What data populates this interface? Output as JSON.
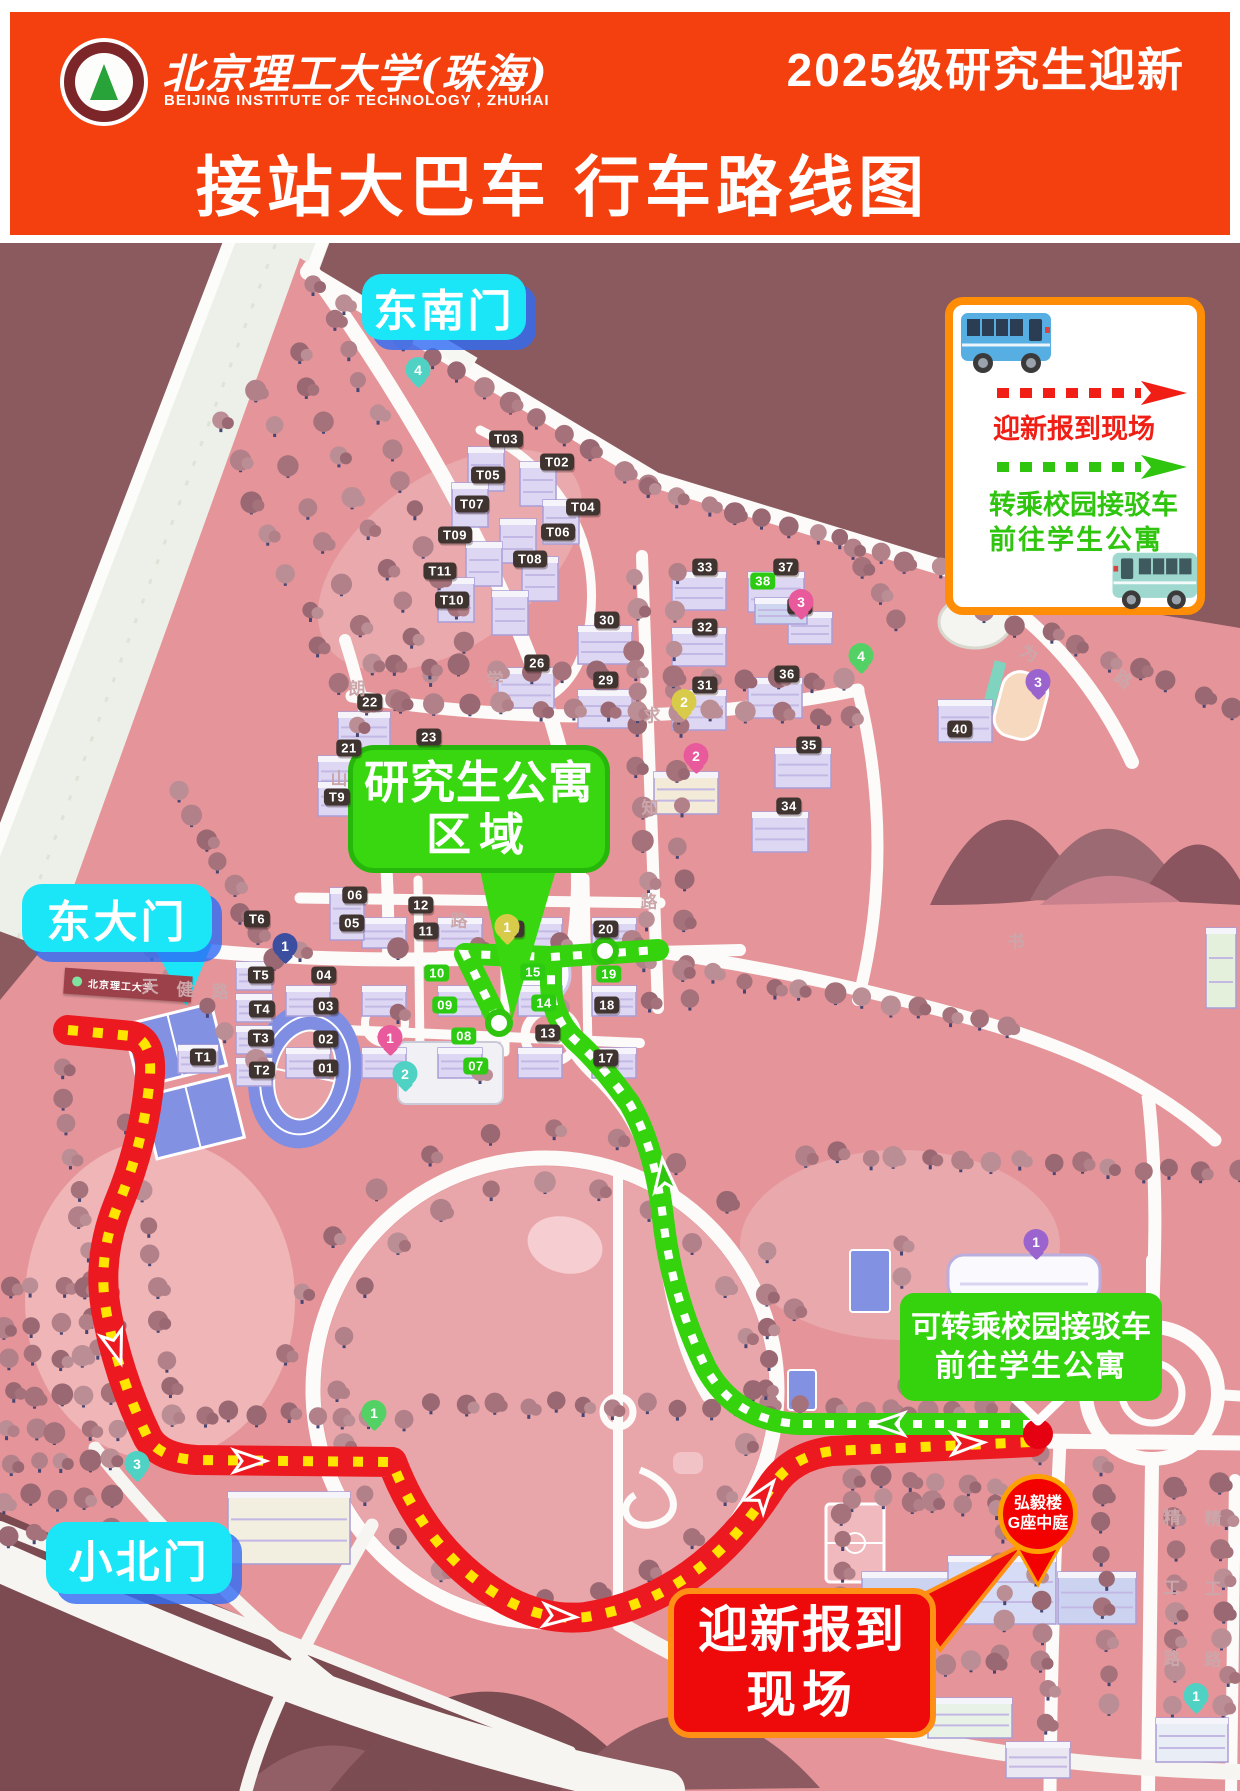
{
  "header": {
    "university_zh": "北京理工大学(珠海)",
    "university_en": "BEIJING INSTITUTE OF TECHNOLOGY , ZHUHAI",
    "event": "2025级研究生迎新",
    "title": "接站大巴车 行车路线图"
  },
  "legend": {
    "red_route_label": "迎新报到现场",
    "green_route_label_line1": "转乘校园接驳车",
    "green_route_label_line2": "前往学生公寓",
    "bus_icon_1": "blue-bus-icon",
    "bus_icon_2": "teal-shuttle-bus-icon"
  },
  "gates": [
    {
      "label": "东南门",
      "x": 362,
      "y": 274,
      "w": 164,
      "h": 66,
      "tail": false
    },
    {
      "label": "东大门",
      "x": 22,
      "y": 884,
      "w": 190,
      "h": 68,
      "tail": true
    },
    {
      "label": "小北门",
      "x": 46,
      "y": 1522,
      "w": 186,
      "h": 72,
      "tail": false
    }
  ],
  "callouts": {
    "grad_area_line1": "研究生公寓",
    "grad_area_line2": "区域",
    "transfer_line1": "可转乘校园接驳车",
    "transfer_line2": "前往学生公寓",
    "report_line1": "迎新报到",
    "report_line2": "现场",
    "hongyi_pin_line1": "弘毅楼",
    "hongyi_pin_line2": "G座中庭",
    "gate_sign": "北京理工大学"
  },
  "building_badges": [
    {
      "t": "T03",
      "x": 506,
      "y": 439,
      "v": "dark"
    },
    {
      "t": "T02",
      "x": 557,
      "y": 462,
      "v": "dark"
    },
    {
      "t": "T05",
      "x": 488,
      "y": 475,
      "v": "dark"
    },
    {
      "t": "T07",
      "x": 472,
      "y": 504,
      "v": "dark"
    },
    {
      "t": "T04",
      "x": 583,
      "y": 507,
      "v": "dark"
    },
    {
      "t": "T06",
      "x": 558,
      "y": 532,
      "v": "dark"
    },
    {
      "t": "T09",
      "x": 455,
      "y": 535,
      "v": "dark"
    },
    {
      "t": "T08",
      "x": 530,
      "y": 559,
      "v": "dark"
    },
    {
      "t": "T11",
      "x": 440,
      "y": 571,
      "v": "dark"
    },
    {
      "t": "T10",
      "x": 452,
      "y": 600,
      "v": "dark"
    },
    {
      "t": "22",
      "x": 370,
      "y": 702,
      "v": "dark"
    },
    {
      "t": "21",
      "x": 349,
      "y": 748,
      "v": "dark"
    },
    {
      "t": "23",
      "x": 429,
      "y": 737,
      "v": "dark"
    },
    {
      "t": "26",
      "x": 537,
      "y": 663,
      "v": "dark"
    },
    {
      "t": "29",
      "x": 606,
      "y": 680,
      "v": "dark"
    },
    {
      "t": "30",
      "x": 607,
      "y": 620,
      "v": "dark"
    },
    {
      "t": "31",
      "x": 705,
      "y": 685,
      "v": "dark"
    },
    {
      "t": "32",
      "x": 705,
      "y": 627,
      "v": "dark"
    },
    {
      "t": "33",
      "x": 705,
      "y": 567,
      "v": "dark"
    },
    {
      "t": "37",
      "x": 786,
      "y": 567,
      "v": "dark"
    },
    {
      "t": "36",
      "x": 787,
      "y": 674,
      "v": "dark"
    },
    {
      "t": "35",
      "x": 809,
      "y": 745,
      "v": "dark"
    },
    {
      "t": "34",
      "x": 789,
      "y": 806,
      "v": "dark"
    },
    {
      "t": "41",
      "x": 800,
      "y": 606,
      "v": "dark"
    },
    {
      "t": "40",
      "x": 960,
      "y": 729,
      "v": "dark"
    },
    {
      "t": "38",
      "x": 763,
      "y": 581,
      "v": "green"
    },
    {
      "t": "16",
      "x": 512,
      "y": 929,
      "v": "dark"
    },
    {
      "t": "20",
      "x": 606,
      "y": 929,
      "v": "dark"
    },
    {
      "t": "12",
      "x": 421,
      "y": 905,
      "v": "dark"
    },
    {
      "t": "11",
      "x": 426,
      "y": 931,
      "v": "dark"
    },
    {
      "t": "13",
      "x": 548,
      "y": 1033,
      "v": "dark"
    },
    {
      "t": "18",
      "x": 607,
      "y": 1005,
      "v": "dark"
    },
    {
      "t": "17",
      "x": 606,
      "y": 1058,
      "v": "dark"
    },
    {
      "t": "06",
      "x": 355,
      "y": 895,
      "v": "dark"
    },
    {
      "t": "05",
      "x": 352,
      "y": 923,
      "v": "dark"
    },
    {
      "t": "T9",
      "x": 337,
      "y": 797,
      "v": "dark"
    },
    {
      "t": "T6",
      "x": 257,
      "y": 919,
      "v": "dark"
    },
    {
      "t": "T5",
      "x": 261,
      "y": 975,
      "v": "dark"
    },
    {
      "t": "T4",
      "x": 262,
      "y": 1009,
      "v": "dark"
    },
    {
      "t": "T3",
      "x": 261,
      "y": 1038,
      "v": "dark"
    },
    {
      "t": "T2",
      "x": 262,
      "y": 1070,
      "v": "dark"
    },
    {
      "t": "T1",
      "x": 203,
      "y": 1057,
      "v": "dark"
    },
    {
      "t": "04",
      "x": 324,
      "y": 975,
      "v": "dark"
    },
    {
      "t": "03",
      "x": 326,
      "y": 1006,
      "v": "dark"
    },
    {
      "t": "02",
      "x": 326,
      "y": 1039,
      "v": "dark"
    },
    {
      "t": "01",
      "x": 326,
      "y": 1068,
      "v": "dark"
    },
    {
      "t": "10",
      "x": 437,
      "y": 973,
      "v": "green"
    },
    {
      "t": "15",
      "x": 533,
      "y": 972,
      "v": "green"
    },
    {
      "t": "19",
      "x": 609,
      "y": 974,
      "v": "green"
    },
    {
      "t": "09",
      "x": 445,
      "y": 1005,
      "v": "green"
    },
    {
      "t": "14",
      "x": 544,
      "y": 1003,
      "v": "green"
    },
    {
      "t": "08",
      "x": 464,
      "y": 1036,
      "v": "green"
    },
    {
      "t": "07",
      "x": 476,
      "y": 1066,
      "v": "green"
    }
  ],
  "map_pins": [
    {
      "n": "4",
      "x": 418,
      "y": 374,
      "c": "teal"
    },
    {
      "n": "1",
      "x": 507,
      "y": 931,
      "c": "yellow"
    },
    {
      "n": "2",
      "x": 684,
      "y": 706,
      "c": "yellow"
    },
    {
      "n": "2",
      "x": 696,
      "y": 760,
      "c": "pink"
    },
    {
      "n": "3",
      "x": 801,
      "y": 606,
      "c": "pink"
    },
    {
      "n": "4",
      "x": 861,
      "y": 660,
      "c": "green"
    },
    {
      "n": "3",
      "x": 1038,
      "y": 686,
      "c": "purple"
    },
    {
      "n": "1",
      "x": 390,
      "y": 1042,
      "c": "pink"
    },
    {
      "n": "2",
      "x": 405,
      "y": 1078,
      "c": "teal"
    },
    {
      "n": "1",
      "x": 374,
      "y": 1417,
      "c": "green"
    },
    {
      "n": "3",
      "x": 137,
      "y": 1468,
      "c": "teal"
    },
    {
      "n": "1",
      "x": 1036,
      "y": 1246,
      "c": "purple"
    },
    {
      "n": "1",
      "x": 1196,
      "y": 1700,
      "c": "teal"
    },
    {
      "n": "1",
      "x": 285,
      "y": 950,
      "c": "blue"
    }
  ],
  "road_labels": [
    {
      "t": "为",
      "x": 1030,
      "y": 652,
      "r": 28
    },
    {
      "t": "路",
      "x": 1124,
      "y": 678,
      "r": 35
    },
    {
      "t": "天",
      "x": 150,
      "y": 985,
      "r": 0
    },
    {
      "t": "健",
      "x": 185,
      "y": 988,
      "r": 0
    },
    {
      "t": "路",
      "x": 220,
      "y": 990,
      "r": 0
    },
    {
      "t": "求",
      "x": 652,
      "y": 714,
      "r": 0
    },
    {
      "t": "知",
      "x": 650,
      "y": 806,
      "r": 0
    },
    {
      "t": "路",
      "x": 649,
      "y": 900,
      "r": 0
    },
    {
      "t": "朗",
      "x": 357,
      "y": 687,
      "r": 0
    },
    {
      "t": "山",
      "x": 339,
      "y": 777,
      "r": 0
    },
    {
      "t": "路",
      "x": 459,
      "y": 919,
      "r": 0
    },
    {
      "t": "书",
      "x": 1016,
      "y": 940,
      "r": 0
    },
    {
      "t": "学",
      "x": 495,
      "y": 678,
      "r": 0
    },
    {
      "t": "精",
      "x": 1172,
      "y": 1516,
      "r": 0
    },
    {
      "t": "工",
      "x": 1172,
      "y": 1586,
      "r": 0
    },
    {
      "t": "路",
      "x": 1172,
      "y": 1657,
      "r": 0
    },
    {
      "t": "精",
      "x": 1213,
      "y": 1517,
      "r": 0
    },
    {
      "t": "工",
      "x": 1213,
      "y": 1587,
      "r": 0
    },
    {
      "t": "路",
      "x": 1213,
      "y": 1658,
      "r": 0
    }
  ],
  "colors": {
    "banner_red": "#f4400f",
    "map_dark": "#8b5a5f",
    "campus_pink": "#e59599",
    "route_red": "#ec1a20",
    "route_yellow": "#ffe400",
    "route_green": "#35d30d",
    "label_cyan": "#1ae6f7",
    "legend_orange": "#ff8d05",
    "badge_dark": "#403430",
    "badge_green": "#2ccb12"
  }
}
